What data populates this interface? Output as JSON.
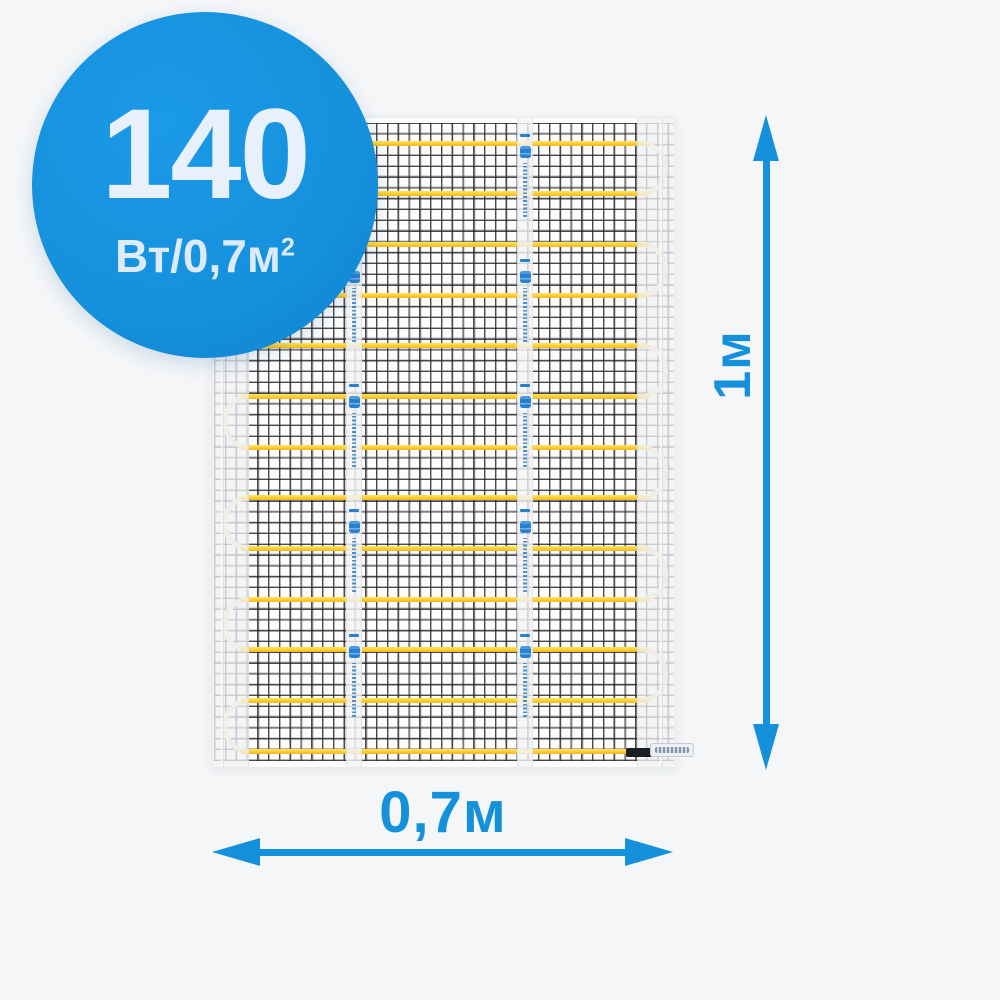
{
  "product": {
    "badge": {
      "value": "140",
      "unit": "Вт/0,7м",
      "unit_sup": "2"
    },
    "dimensions": {
      "height": "1м",
      "width": "0,7м"
    }
  },
  "mat": {
    "cable_runs": 13,
    "run_top_base": 22.5,
    "run_spacing": 50.67,
    "right_turn_pairs": [
      [
        0,
        1
      ],
      [
        2,
        3
      ],
      [
        4,
        5
      ],
      [
        6,
        7
      ],
      [
        8,
        9
      ],
      [
        10,
        11
      ]
    ],
    "left_turn_pairs": [
      [
        1,
        2
      ],
      [
        3,
        4
      ],
      [
        5,
        6
      ],
      [
        7,
        8
      ],
      [
        9,
        10
      ],
      [
        11,
        12
      ]
    ],
    "tape_left_px": [
      133,
      304
    ],
    "tape_groups": 5,
    "tape_group_top": 16,
    "tape_group_spacing": 125
  },
  "colors": {
    "accent_blue": "#1590db",
    "cable_yellow": "#ffd02f",
    "turn_cream": "#f0e4ba",
    "background": "#f4f6f8"
  }
}
